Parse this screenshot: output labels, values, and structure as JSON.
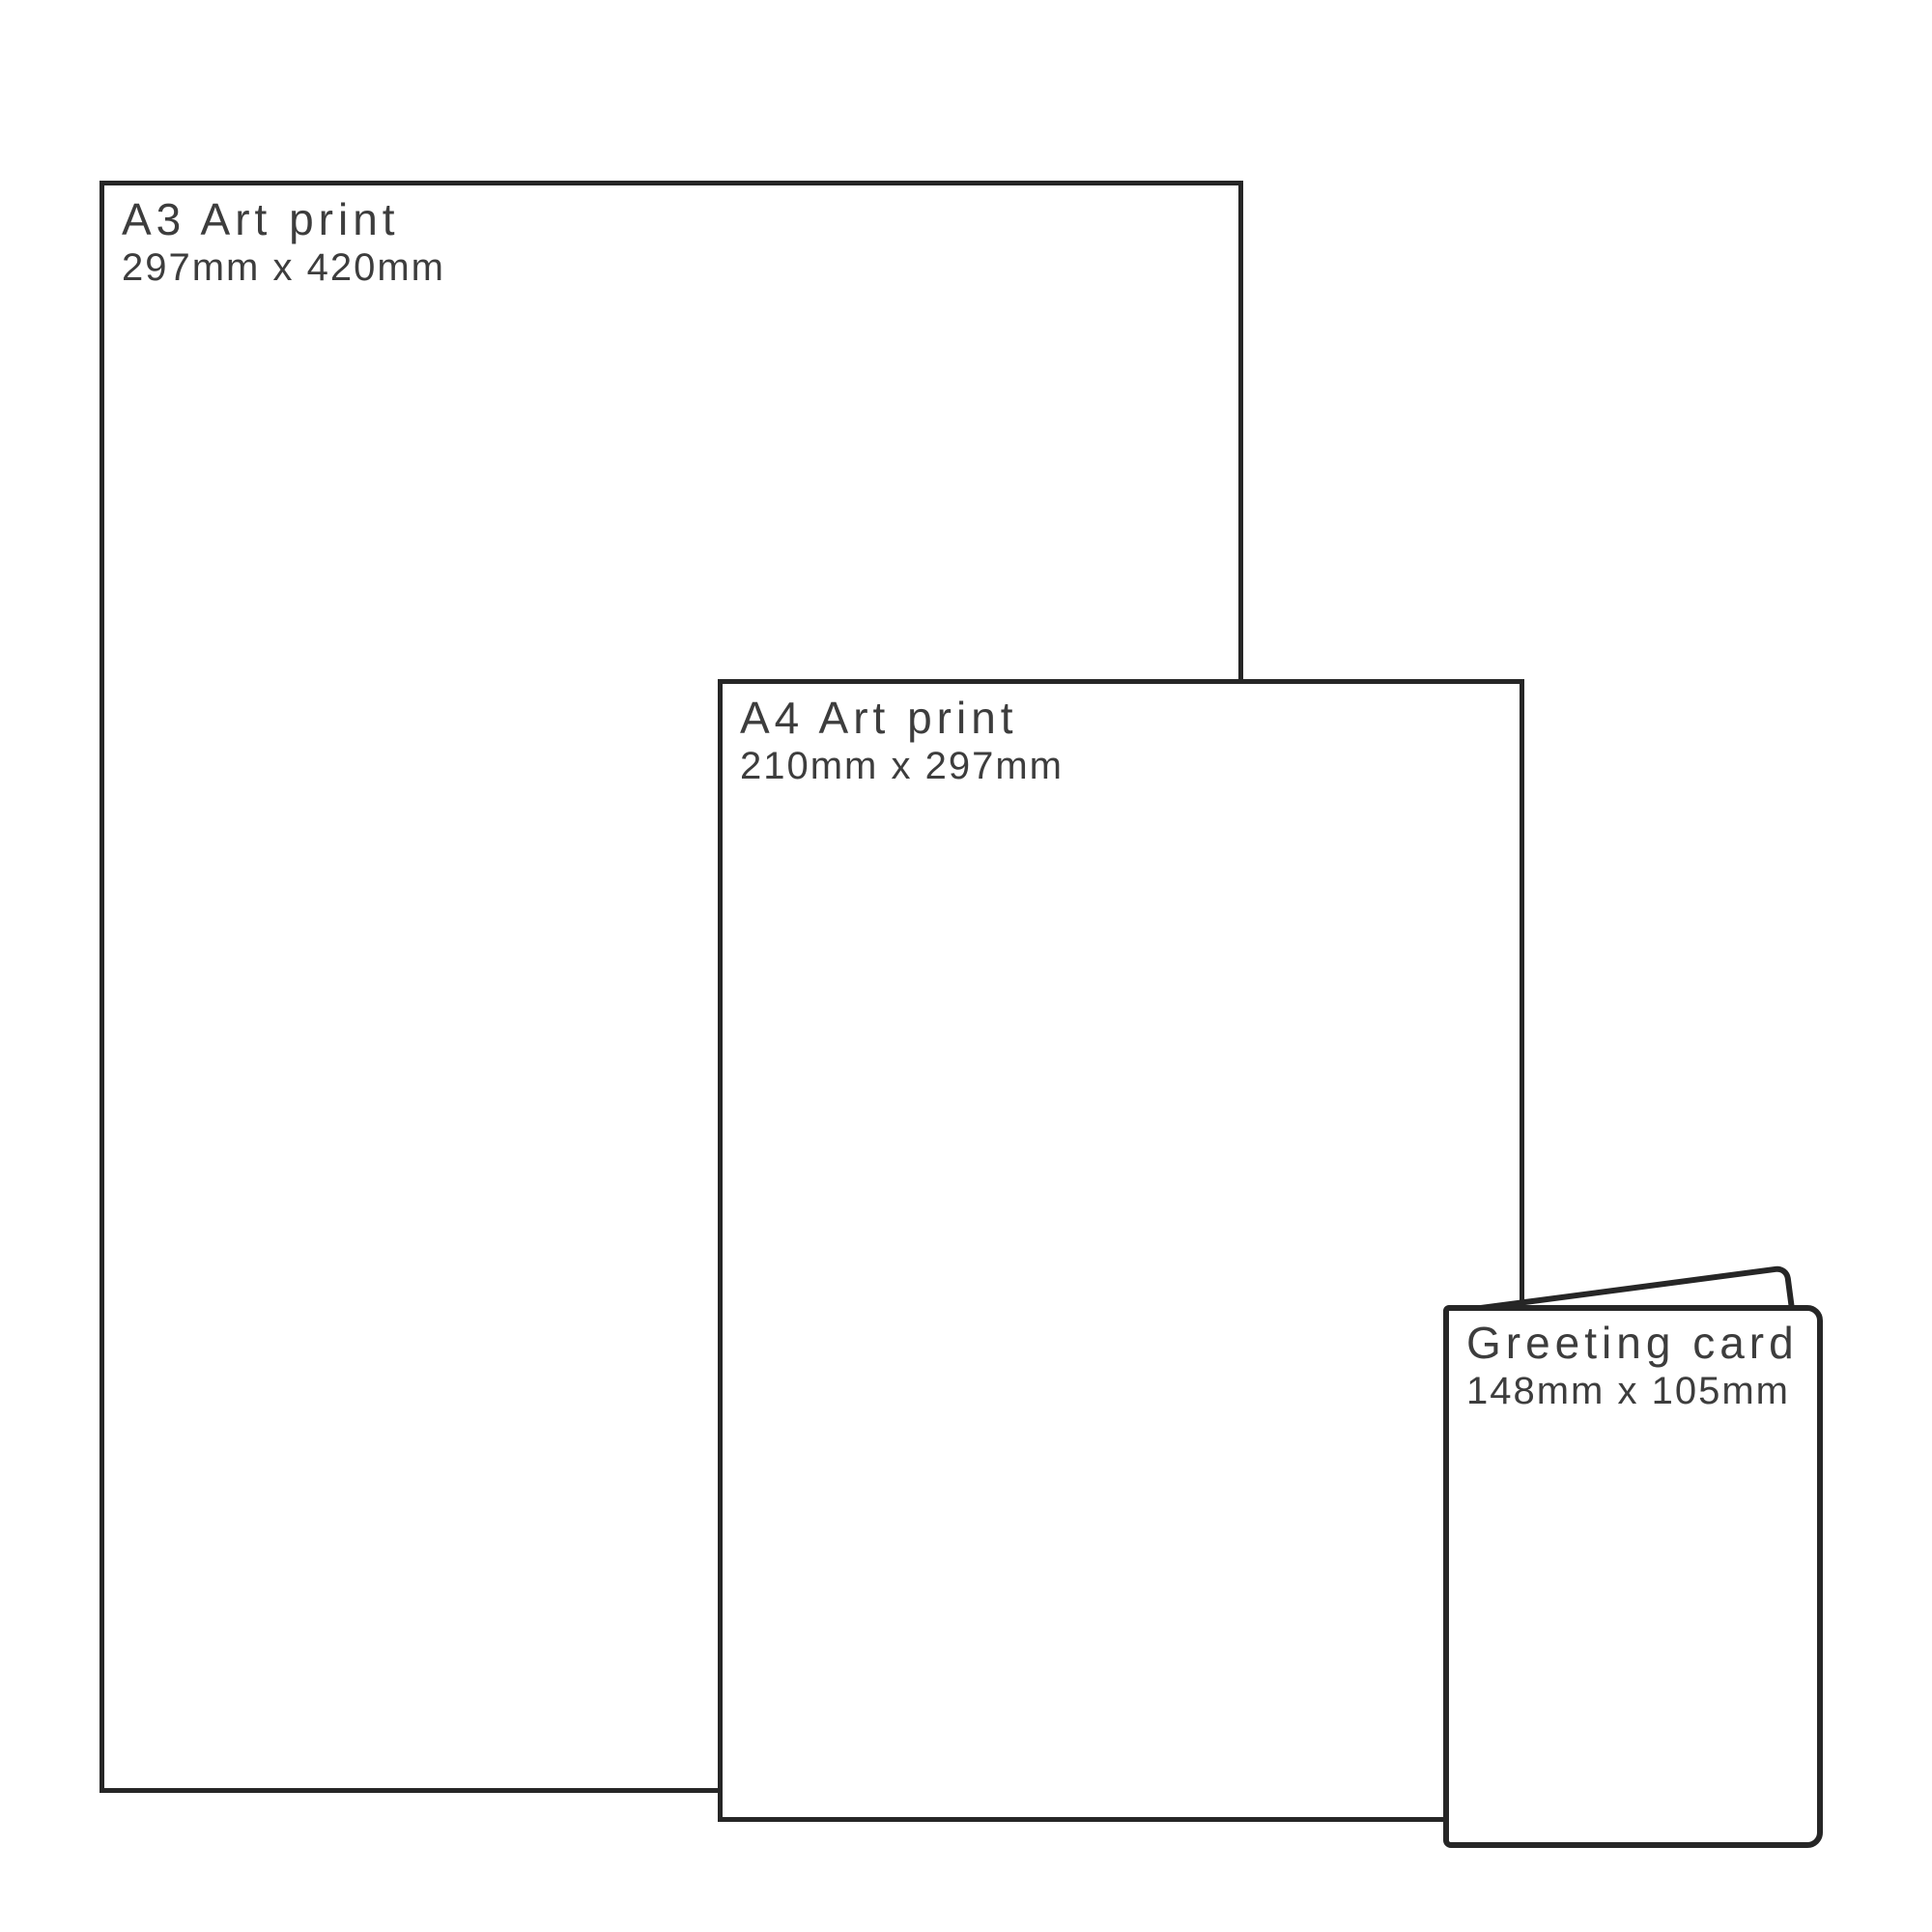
{
  "diagram": {
    "kind": "print-size-comparison",
    "background": "#ffffff",
    "outline_color": "#262626",
    "text_color": "#3d3d3d",
    "items": [
      {
        "id": "a3",
        "title": "A3 Art print",
        "dimensions": "297mm x 420mm"
      },
      {
        "id": "a4",
        "title": "A4 Art print",
        "dimensions": "210mm x 297mm"
      },
      {
        "id": "card",
        "title": "Greeting card",
        "dimensions": "148mm x 105mm"
      }
    ]
  }
}
